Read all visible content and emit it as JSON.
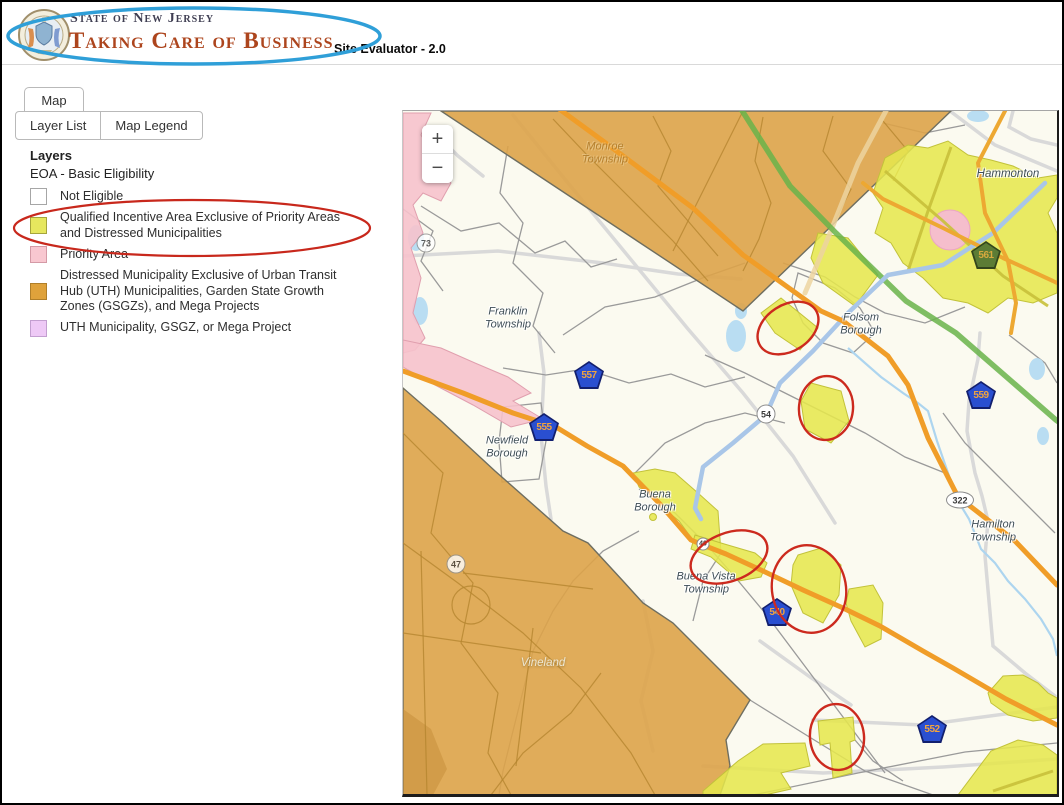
{
  "header": {
    "state_line": "State of New Jersey",
    "title": "Taking Care of Business",
    "subtitle": "Site Evaluator - 2.0",
    "annotation_color": "#2f9fd8"
  },
  "tabs": [
    {
      "label": "Map"
    }
  ],
  "toolbar": {
    "layer_list_label": "Layer List",
    "map_legend_label": "Map Legend"
  },
  "legend": {
    "title": "Layers",
    "subtitle": "EOA - Basic Eligibility",
    "annotation_color": "#c8281c",
    "items": [
      {
        "label": "Not Eligible",
        "color": "#ffffff"
      },
      {
        "label": "Qualified Incentive Area Exclusive of Priority Areas and Distressed Municipalities",
        "color": "#e6e75e",
        "annotated": true
      },
      {
        "label": "Priority Area",
        "color": "#f8c7d0"
      },
      {
        "label": "Distressed Municipality Exclusive of Urban Transit Hub (UTH) Municipalities, Garden State Growth Zones (GSGZs), and Mega Projects",
        "color": "#dfa23b"
      },
      {
        "label": "UTH Municipality, GSGZ, or Mega Project",
        "color": "#eec9f6"
      }
    ]
  },
  "map": {
    "zoom_in_label": "+",
    "zoom_out_label": "−",
    "annotation_color": "#cc2a1e",
    "zone_colors": {
      "eligible_yellow": "#e6e74e",
      "priority_pink": "#f6c2cc",
      "distressed_orange": "#dda349",
      "uth_violet": "#eec9f6"
    },
    "towns": [
      {
        "line1": "Monroe",
        "line2": "Township"
      },
      {
        "line1": "Hammonton",
        "line2": ""
      },
      {
        "line1": "Franklin",
        "line2": "Township"
      },
      {
        "line1": "Folsom",
        "line2": "Borough"
      },
      {
        "line1": "Newfield",
        "line2": "Borough"
      },
      {
        "line1": "Buena",
        "line2": "Borough"
      },
      {
        "line1": "Buena Vista",
        "line2": "Township"
      },
      {
        "line1": "Hamilton",
        "line2": "Township"
      },
      {
        "line1": "Vineland",
        "line2": ""
      }
    ],
    "route_shields": {
      "pentagons": [
        {
          "number": "557"
        },
        {
          "number": "555"
        },
        {
          "number": "559"
        },
        {
          "number": "561"
        },
        {
          "number": "540"
        },
        {
          "number": "552"
        }
      ],
      "circles": [
        {
          "number": "54"
        },
        {
          "number": "47"
        },
        {
          "number": "73"
        },
        {
          "number": "40"
        }
      ],
      "ovals": [
        {
          "number": "322"
        }
      ]
    }
  }
}
